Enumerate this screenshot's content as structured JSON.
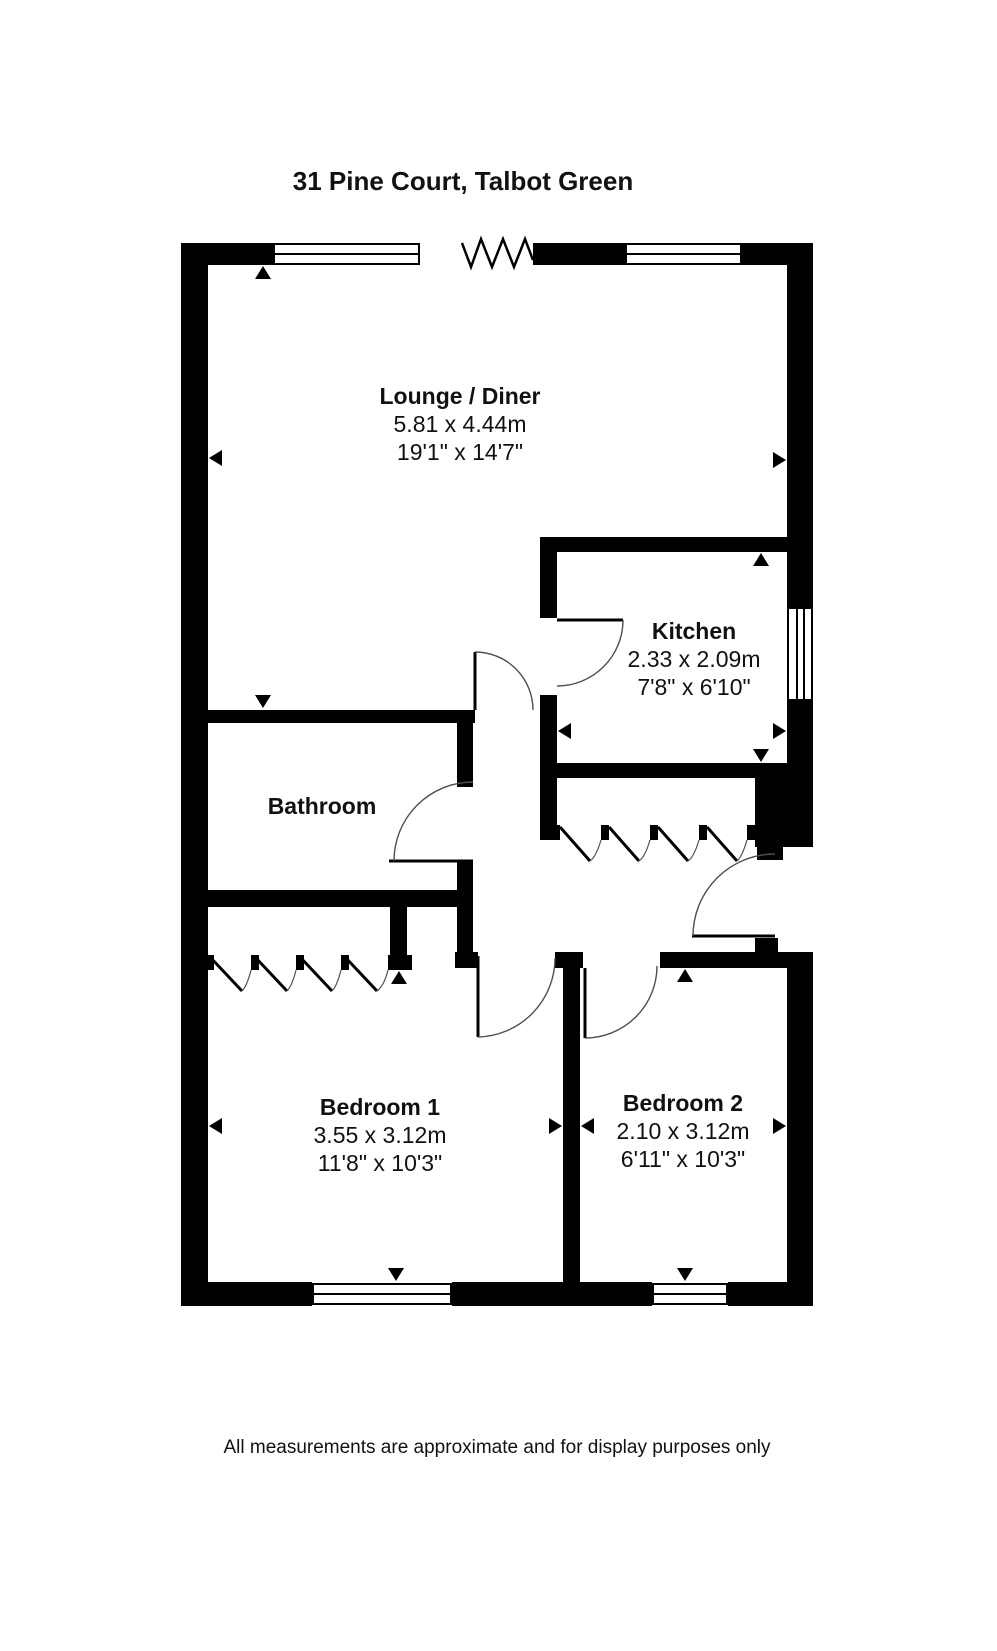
{
  "title": "31 Pine Court, Talbot Green",
  "rooms": {
    "lounge": {
      "name": "Lounge / Diner",
      "metric": "5.81 x 4.44m",
      "imperial": "19'1\" x 14'7\""
    },
    "kitchen": {
      "name": "Kitchen",
      "metric": "2.33 x 2.09m",
      "imperial": "7'8\" x 6'10\""
    },
    "bathroom": {
      "name": "Bathroom"
    },
    "bedroom1": {
      "name": "Bedroom 1",
      "metric": "3.55 x 3.12m",
      "imperial": "11'8\" x 10'3\""
    },
    "bedroom2": {
      "name": "Bedroom 2",
      "metric": "2.10 x 3.12m",
      "imperial": "6'11\" x 10'3\""
    }
  },
  "footer": {
    "disclaimer": "All measurements are approximate and for display purposes only"
  },
  "colors": {
    "walls": "#000000",
    "background": "#ffffff",
    "door_arc": "#4f4f4f"
  },
  "plan_symbols": {
    "window": "white band with centre glazing line",
    "door": "leaf line with quarter-circle swing arc",
    "wardrobe": "bifold panel diagonals with swing arcs",
    "wall_break": "zigzag opening symbol",
    "measure_marker": "solid triangle arrow"
  }
}
